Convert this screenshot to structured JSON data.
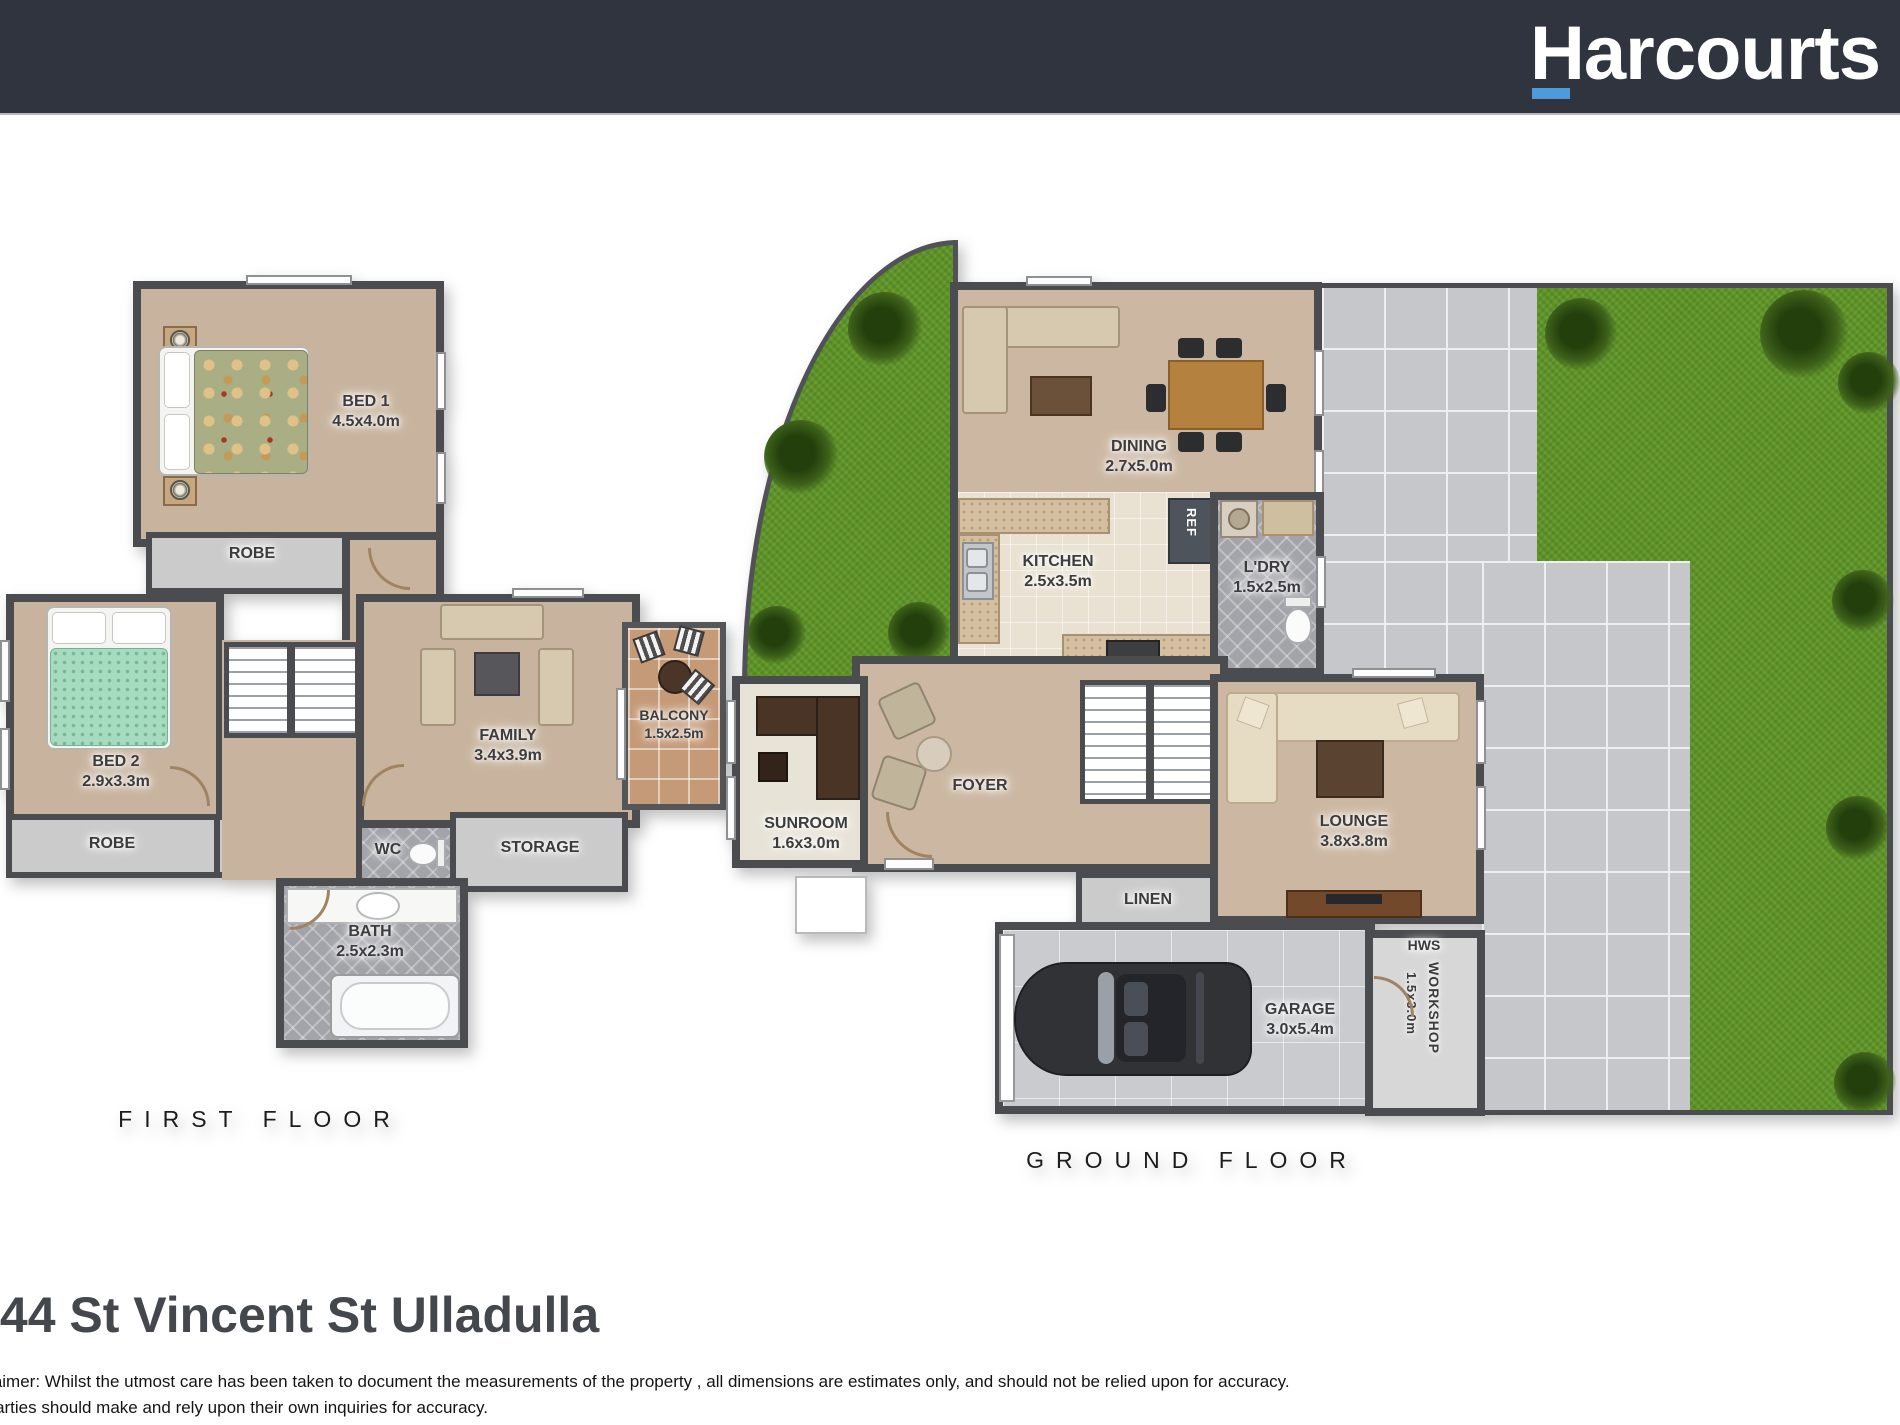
{
  "header": {
    "brand": "Harcourts",
    "colors": {
      "bar": "#2f343e",
      "underline": "#4f9ad8"
    }
  },
  "first_floor": {
    "title": "FIRST FLOOR",
    "rooms": {
      "bed1": {
        "label": "BED 1",
        "dims": "4.5x4.0m"
      },
      "robe1": {
        "label": "ROBE"
      },
      "bed2": {
        "label": "BED 2",
        "dims": "2.9x3.3m"
      },
      "robe2": {
        "label": "ROBE"
      },
      "st": {
        "label": "ST"
      },
      "wc": {
        "label": "WC"
      },
      "family": {
        "label": "FAMILY",
        "dims": "3.4x3.9m"
      },
      "balcony": {
        "label": "BALCONY",
        "dims": "1.5x2.5m"
      },
      "storage": {
        "label": "STORAGE"
      },
      "bath": {
        "label": "BATH",
        "dims": "2.5x2.3m"
      }
    }
  },
  "ground_floor": {
    "title": "GROUND FLOOR",
    "rooms": {
      "dining": {
        "label": "DINING",
        "dims": "2.7x5.0m"
      },
      "kitchen": {
        "label": "KITCHEN",
        "dims": "2.5x3.5m"
      },
      "ref": {
        "label": "REF"
      },
      "ldry": {
        "label": "L'DRY",
        "dims": "1.5x2.5m"
      },
      "sunroom": {
        "label": "SUNROOM",
        "dims": "1.6x3.0m"
      },
      "foyer": {
        "label": "FOYER"
      },
      "lounge": {
        "label": "LOUNGE",
        "dims": "3.8x3.8m"
      },
      "linen": {
        "label": "LINEN"
      },
      "garage": {
        "label": "GARAGE",
        "dims": "3.0x5.4m"
      },
      "hws": {
        "label": "HWS"
      },
      "workshop": {
        "label": "WORKSHOP",
        "dims": "1.5x3.0m"
      }
    }
  },
  "footer": {
    "address": "/44 St Vincent St Ulladulla",
    "disclaimer_line1": "Disclaimer: Whilst the utmost care has been taken to document the measurements of the property , all dimensions are estimates only, and should not be relied upon for accuracy.",
    "disclaimer_line2": "All parties should make and rely upon their own inquiries for accuracy."
  },
  "colors": {
    "wall": "#4b4c4f",
    "carpet": "#c8b49e",
    "grass": "#5f9427",
    "paving": "#c5c7cb",
    "tile_gray": "#a3a4aa",
    "balcony_tile": "#c59a77"
  }
}
